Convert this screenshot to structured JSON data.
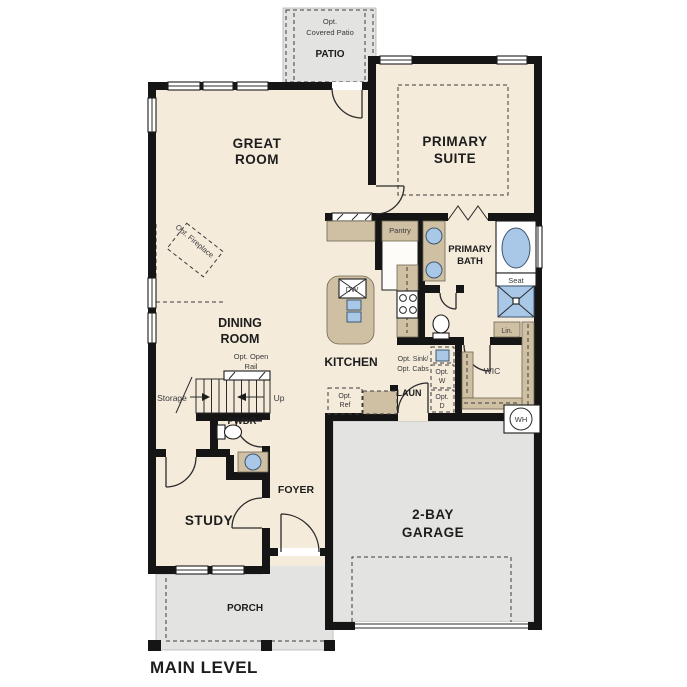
{
  "plan": {
    "title": "MAIN LEVEL",
    "colors": {
      "wall": "#151515",
      "floor": "#f4ebdb",
      "concrete": "#e3e3e1",
      "cabinet": "#cfc0a4",
      "fixture": "#a9c7e7",
      "ink": "#1d1d1d"
    },
    "patio": {
      "opt1": "Opt.",
      "opt2": "Covered Patio",
      "name": "PATIO"
    },
    "great_room": {
      "l1": "GREAT",
      "l2": "ROOM"
    },
    "primary_suite": {
      "l1": "PRIMARY",
      "l2": "SUITE"
    },
    "primary_bath": {
      "l1": "PRIMARY",
      "l2": "BATH",
      "seat": "Seat",
      "lin": "Lin."
    },
    "dining": {
      "l1": "DINING",
      "l2": "ROOM"
    },
    "fireplace": {
      "label": "Opt. Fireplace"
    },
    "stairs": {
      "rail1": "Opt. Open",
      "rail2": "Rail",
      "up": "Up",
      "storage": "Storage"
    },
    "kitchen": {
      "name": "KITCHEN",
      "pantry": "Pantry",
      "dw": "DW",
      "opt_ref_1": "Opt.",
      "opt_ref_2": "Ref",
      "opt_sink_1": "Opt. Sink/",
      "opt_sink_2": "Opt. Cabs"
    },
    "laundry": {
      "name": "LAUN",
      "opt_w_1": "Opt.",
      "opt_w_2": "W",
      "opt_d_1": "Opt.",
      "opt_d_2": "D"
    },
    "wic": {
      "name": "WIC"
    },
    "water_heater": {
      "name": "WH"
    },
    "pwdr": {
      "name": "PWDR"
    },
    "foyer": {
      "name": "FOYER"
    },
    "study": {
      "name": "STUDY"
    },
    "garage": {
      "l1": "2-BAY",
      "l2": "GARAGE"
    },
    "porch": {
      "name": "PORCH"
    }
  }
}
